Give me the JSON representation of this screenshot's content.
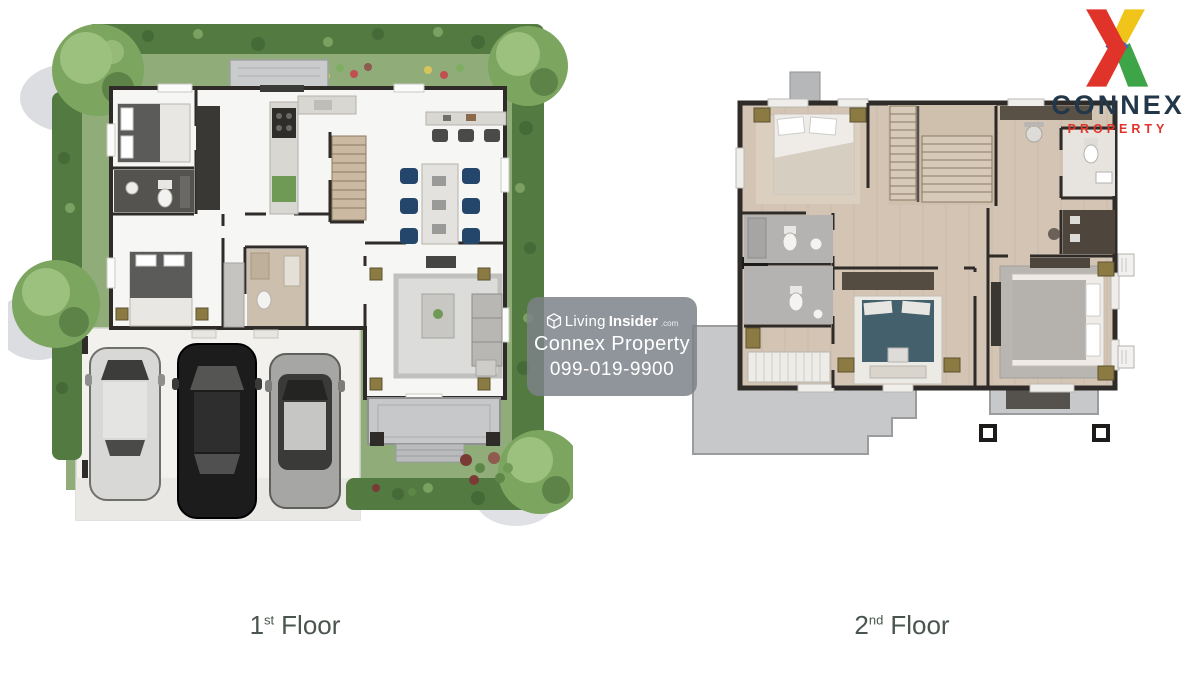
{
  "logo": {
    "brand": "CONNEX",
    "tagline": "PROPERTY"
  },
  "watermark": {
    "brand_light": "Living",
    "brand_bold": "Insider",
    "brand_suffix": ".com",
    "company": "Connex Property",
    "phone": "099-019-9900"
  },
  "floors": [
    {
      "id": "first",
      "label_number": "1",
      "label_sup": "st",
      "label_word": "Floor"
    },
    {
      "id": "second",
      "label_number": "2",
      "label_sup": "nd",
      "label_word": "Floor"
    }
  ],
  "colors": {
    "hedge": "#527a41",
    "hedge_dark": "#3f6133",
    "grass": "#8fac79",
    "tree": "#7ca55f",
    "tree_light": "#9cc07e",
    "wall": "#2e2b28",
    "wood": "#d3c4b3",
    "balcony": "#c6c8ca",
    "chair_navy": "#24466b",
    "teal_bed": "#44606c",
    "gold": "#8b7a42",
    "label": "#4a554e",
    "watermark_bg": "rgba(125,131,137,0.85)",
    "logo_navy": "#22384a",
    "logo_red": "#e0342b",
    "logo_yellow": "#f0c419",
    "logo_green": "#3da547",
    "logo_blue": "#3e68c6"
  }
}
